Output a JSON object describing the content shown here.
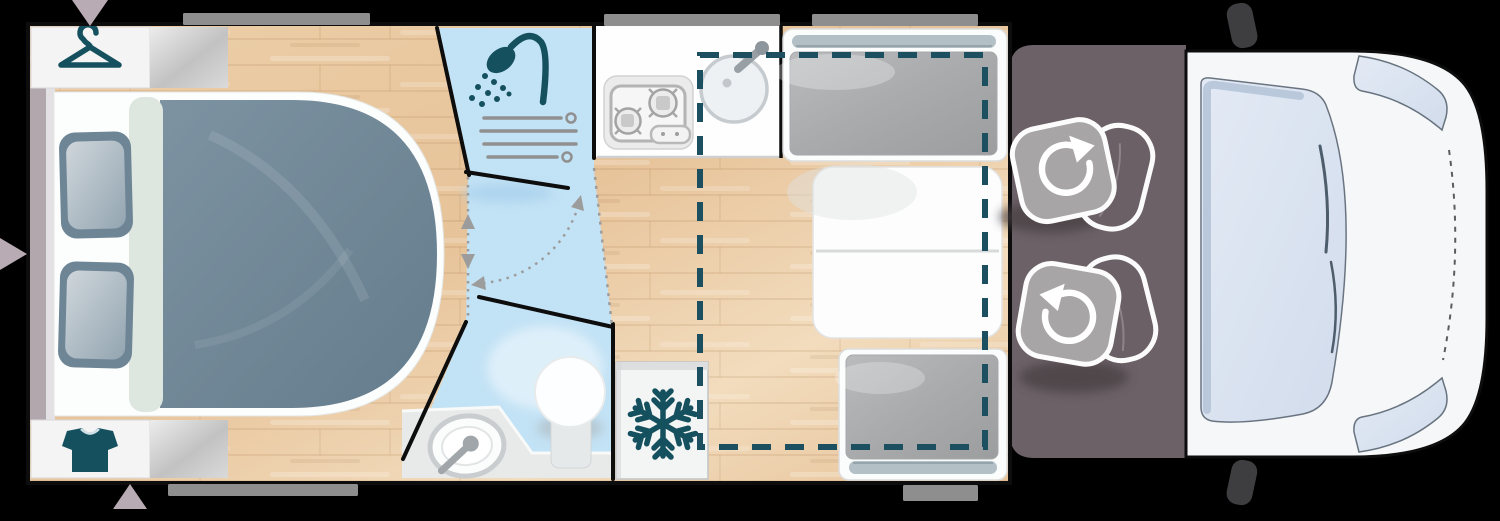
{
  "scene": {
    "type": "motorhome-floorplan-top-view",
    "zones": [
      "bedroom-island-bed",
      "wardrobe-hanging",
      "wardrobe-cabinet",
      "washroom-shower",
      "washroom-toilet-basin",
      "kitchen-counter",
      "refrigerator",
      "dinette-front-bench",
      "dinette-rear-bench",
      "dinette-table",
      "drop-down-bed-outline",
      "cab-floor",
      "cab-swivel-seats",
      "vehicle-cab-front"
    ]
  },
  "icons": [
    "hanger-icon",
    "tshirt-icon",
    "shower-head-icon",
    "towel-rails-icon",
    "snowflake-icon",
    "hob-burners-icon",
    "sink-icon",
    "toilet-icon",
    "washbasin-icon",
    "seat-rotation-arrow-icon",
    "door-swing-arrows-icon",
    "vent-triangle-icon"
  ],
  "colors": {
    "bg": "#000000",
    "outline": "#0d0d0d",
    "wood_a": "#eccfa9",
    "wood_b": "#e7c399",
    "wood_c": "#f2dcbd",
    "bath_blue": "#c2e2f5",
    "bath_blue_deep": "#a6cfeb",
    "teal": "#15505f",
    "dash_teal": "#1c4f60",
    "cushion_gray": "#a8aaac",
    "headrest_gray": "#b3c0c6",
    "duvet_a": "#7d93a2",
    "duvet_b": "#647c8c",
    "pillow_edge": "#6d8595",
    "pillow_lite": "#cfd6db",
    "cab_floor": "#6c6167",
    "seat_cushion": "#a8a5a7",
    "seat_back": "#6b6065",
    "body_white": "#f6f7f8",
    "glass_a": "#e3eaf5",
    "glass_b": "#d2dcec",
    "glass_edge": "#b5c5d8",
    "ext_gray": "#8e8e8e",
    "mauve": "#b9abb3",
    "head_mauve": "#b2a7ad",
    "platform_gray": "#e8eaea",
    "arrow_gray": "#9c9c9c"
  }
}
